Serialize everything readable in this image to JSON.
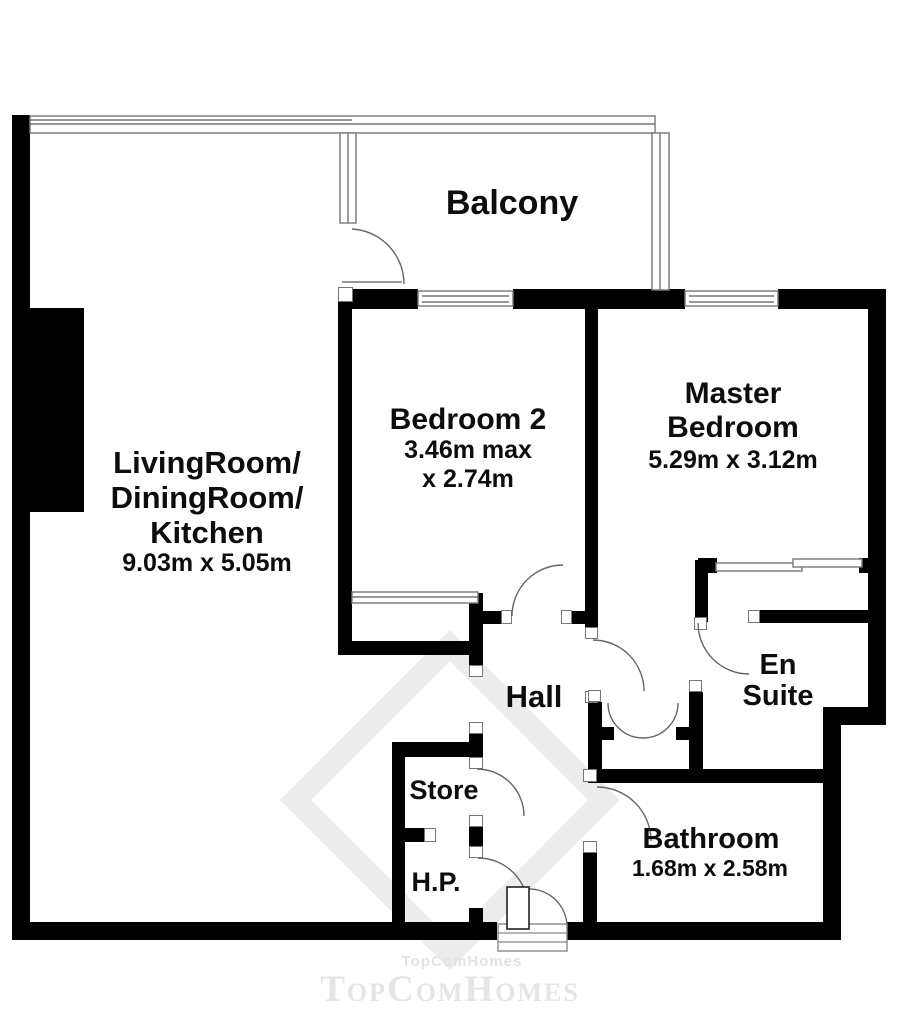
{
  "colors": {
    "wall": "#000000",
    "thin_line": "#777777",
    "text": "#0d0d0d",
    "watermark": "#e5e5e5"
  },
  "rooms": {
    "balcony": {
      "name": "Balcony"
    },
    "living": {
      "name1": "LivingRoom/",
      "name2": "DiningRoom/",
      "name3": "Kitchen",
      "dims": "9.03m x 5.05m"
    },
    "bedroom2": {
      "name": "Bedroom 2",
      "dims1": "3.46m max",
      "dims2": "x 2.74m"
    },
    "master": {
      "name1": "Master",
      "name2": "Bedroom",
      "dims": "5.29m x 3.12m"
    },
    "hall": {
      "name": "Hall"
    },
    "ensuite": {
      "name1": "En",
      "name2": "Suite"
    },
    "store": {
      "name": "Store"
    },
    "hp": {
      "name": "H.P."
    },
    "bathroom": {
      "name": "Bathroom",
      "dims": "1.68m x 2.58m"
    }
  },
  "watermark": {
    "small": "TopComHomes",
    "large": "TopComHomes"
  }
}
